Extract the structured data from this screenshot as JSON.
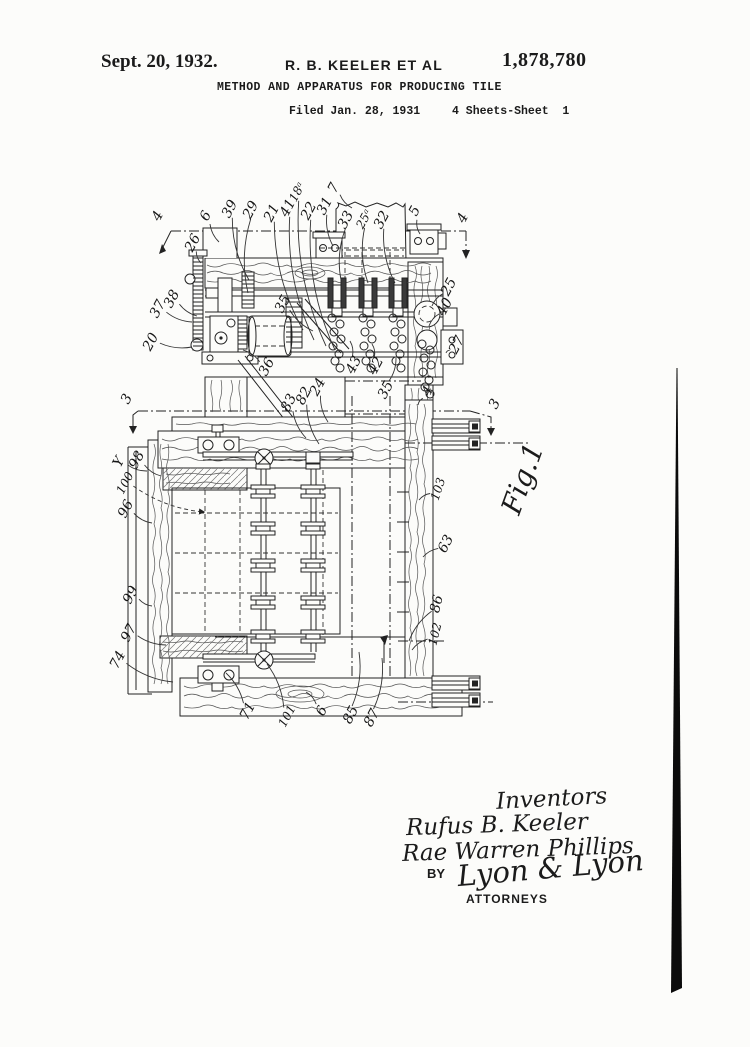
{
  "page": {
    "background": "#fcfcfa",
    "ink": "#1b1b1b"
  },
  "header": {
    "date": "Sept. 20, 1932.",
    "inventor_line": "R. B. KEELER ET AL",
    "patent_number": "1,878,780",
    "title": "METHOD AND APPARATUS FOR PRODUCING TILE",
    "filed": "Filed Jan. 28, 1931",
    "sheet": "4 Sheets-Sheet  1"
  },
  "figure": {
    "label": "Fig.1"
  },
  "signatures": {
    "inventors_heading": "Inventors",
    "inventor1": "Rufus B. Keeler",
    "inventor2": "Rae Warren Phillips",
    "by_label": "BY",
    "attorney_signature": "Lyon & Lyon",
    "attorneys_label": "ATTORNEYS"
  },
  "reference_labels": [
    {
      "t": "4",
      "x": 158,
      "y": 216,
      "r": -62
    },
    {
      "t": "6",
      "x": 206,
      "y": 216,
      "r": -62,
      "tx": 219,
      "ty": 242
    },
    {
      "t": "39",
      "x": 230,
      "y": 209,
      "r": -62,
      "tx": 249,
      "ty": 280
    },
    {
      "t": "29",
      "x": 251,
      "y": 210,
      "r": -62,
      "tx": 248,
      "ty": 293
    },
    {
      "t": "21",
      "x": 272,
      "y": 213,
      "r": -62,
      "tx": 303,
      "ty": 330
    },
    {
      "t": "41",
      "x": 288,
      "y": 208,
      "r": -62,
      "tx": 314,
      "ty": 340
    },
    {
      "t": "18ᵃ",
      "x": 297,
      "y": 192,
      "r": -62,
      "tx": 326,
      "ty": 346
    },
    {
      "t": "22",
      "x": 309,
      "y": 211,
      "r": -62,
      "tx": 335,
      "ty": 350
    },
    {
      "t": "31",
      "x": 325,
      "y": 206,
      "r": -62,
      "tx": 333,
      "ty": 246
    },
    {
      "t": "7",
      "x": 334,
      "y": 188,
      "r": -62,
      "tx": 352,
      "ty": 208
    },
    {
      "t": "33",
      "x": 346,
      "y": 220,
      "r": -62,
      "tx": 341,
      "ty": 280
    },
    {
      "t": "25ᵃ",
      "x": 364,
      "y": 219,
      "r": -62,
      "tx": 368,
      "ty": 283
    },
    {
      "t": "32",
      "x": 382,
      "y": 220,
      "r": -62,
      "tx": 395,
      "ty": 283
    },
    {
      "t": "5",
      "x": 415,
      "y": 211,
      "r": -62,
      "tx": 420,
      "ty": 234
    },
    {
      "t": "4",
      "x": 463,
      "y": 218,
      "r": -62
    },
    {
      "t": "26",
      "x": 193,
      "y": 243,
      "r": -62,
      "tx": 201,
      "ty": 263
    },
    {
      "t": "37",
      "x": 158,
      "y": 309,
      "r": -62,
      "tx": 192,
      "ty": 322
    },
    {
      "t": "38",
      "x": 172,
      "y": 299,
      "r": -62,
      "tx": 197,
      "ty": 316
    },
    {
      "t": "20",
      "x": 151,
      "y": 342,
      "r": -62,
      "tx": 192,
      "ty": 347
    },
    {
      "t": "35",
      "x": 283,
      "y": 304,
      "r": -62,
      "tx": 313,
      "ty": 331
    },
    {
      "t": "36",
      "x": 267,
      "y": 367,
      "r": -62,
      "tx": 243,
      "ty": 350
    },
    {
      "t": "25",
      "x": 449,
      "y": 287,
      "r": -62,
      "tx": 432,
      "ty": 306
    },
    {
      "t": "40",
      "x": 445,
      "y": 307,
      "r": -62,
      "tx": 429,
      "ty": 326
    },
    {
      "t": "27",
      "x": 457,
      "y": 345,
      "r": -62,
      "tx": 446,
      "ty": 353
    },
    {
      "t": "43",
      "x": 354,
      "y": 365,
      "r": -62,
      "tx": 350,
      "ty": 341
    },
    {
      "t": "42",
      "x": 376,
      "y": 366,
      "r": -62,
      "tx": 372,
      "ty": 344
    },
    {
      "t": "35",
      "x": 386,
      "y": 390,
      "r": -62,
      "tx": 396,
      "ty": 358
    },
    {
      "t": "24",
      "x": 318,
      "y": 387,
      "r": -62,
      "tx": 328,
      "ty": 422
    },
    {
      "t": "83",
      "x": 289,
      "y": 403,
      "r": -62,
      "tx": 306,
      "ty": 438
    },
    {
      "t": "82",
      "x": 304,
      "y": 396,
      "r": -62,
      "tx": 319,
      "ty": 444
    },
    {
      "t": "4",
      "x": 428,
      "y": 391,
      "r": -62,
      "tx": 418,
      "ty": 405
    },
    {
      "t": "3",
      "x": 127,
      "y": 399,
      "r": -62
    },
    {
      "t": "3",
      "x": 495,
      "y": 404,
      "r": -62
    },
    {
      "t": "Y",
      "x": 119,
      "y": 462,
      "r": -62,
      "tx": 147,
      "ty": 471
    },
    {
      "t": "98",
      "x": 137,
      "y": 460,
      "r": -62,
      "tx": 161,
      "ty": 476
    },
    {
      "t": "100",
      "x": 125,
      "y": 483,
      "r": -62,
      "tx": 204,
      "ty": 512,
      "ls": "d"
    },
    {
      "t": "96",
      "x": 126,
      "y": 509,
      "r": -62,
      "tx": 152,
      "ty": 523
    },
    {
      "t": "99",
      "x": 131,
      "y": 595,
      "r": -62,
      "tx": 152,
      "ty": 606
    },
    {
      "t": "97",
      "x": 129,
      "y": 633,
      "r": -62,
      "tx": 166,
      "ty": 645
    },
    {
      "t": "74",
      "x": 118,
      "y": 660,
      "r": -62,
      "tx": 173,
      "ty": 682
    },
    {
      "t": "103",
      "x": 438,
      "y": 489,
      "r": -72,
      "tx": 419,
      "ty": 500
    },
    {
      "t": "63",
      "x": 446,
      "y": 544,
      "r": -62,
      "tx": 423,
      "ty": 557
    },
    {
      "t": "86",
      "x": 437,
      "y": 604,
      "r": -76,
      "tx": 409,
      "ty": 641
    },
    {
      "t": "102",
      "x": 435,
      "y": 634,
      "r": -76,
      "tx": 412,
      "ty": 650
    },
    {
      "t": "71",
      "x": 248,
      "y": 711,
      "r": -62,
      "tx": 226,
      "ty": 673
    },
    {
      "t": "101",
      "x": 287,
      "y": 716,
      "r": -62,
      "tx": 267,
      "ty": 664
    },
    {
      "t": "6",
      "x": 322,
      "y": 711,
      "r": -62,
      "tx": 306,
      "ty": 692
    },
    {
      "t": "85",
      "x": 351,
      "y": 715,
      "r": -62,
      "tx": 359,
      "ty": 652
    },
    {
      "t": "87",
      "x": 372,
      "y": 718,
      "r": -62,
      "tx": 382,
      "ty": 658
    }
  ]
}
